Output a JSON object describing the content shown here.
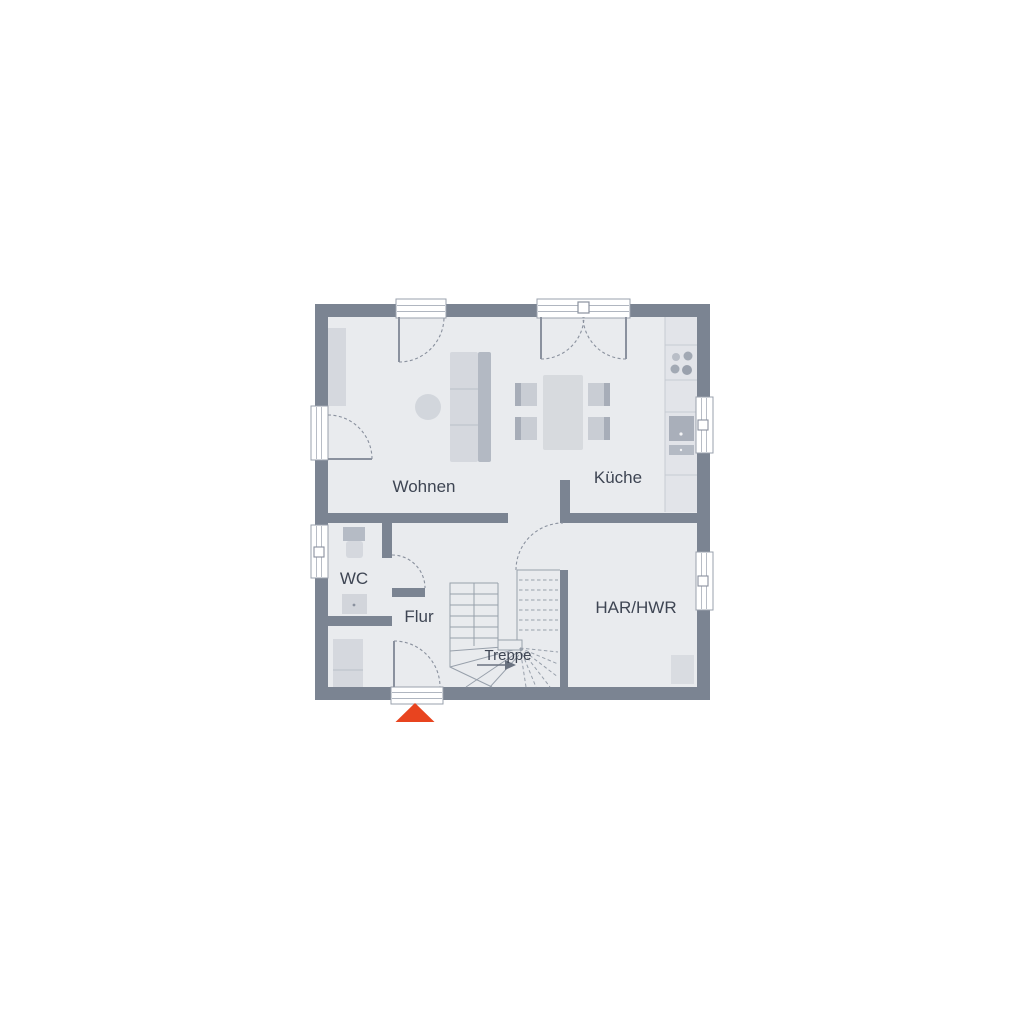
{
  "floorplan": {
    "rooms": [
      {
        "id": "wohnen",
        "label": "Wohnen"
      },
      {
        "id": "kueche",
        "label": "Küche"
      },
      {
        "id": "wc",
        "label": "WC"
      },
      {
        "id": "flur",
        "label": "Flur"
      },
      {
        "id": "treppe",
        "label": "Treppe"
      },
      {
        "id": "har-hwr",
        "label": "HAR/HWR"
      }
    ],
    "colors": {
      "background": "#ffffff",
      "wall": "#7b8492",
      "floor": "#e9ebee",
      "furniture_light": "#d5d8de",
      "furniture_seat": "#c9cdd4",
      "furniture_mid": "#b3b9c3",
      "furniture_dark": "#a2a9b4",
      "line": "#8a919e",
      "label_text": "#3e4553",
      "entrance_marker": "#e8441f"
    }
  }
}
